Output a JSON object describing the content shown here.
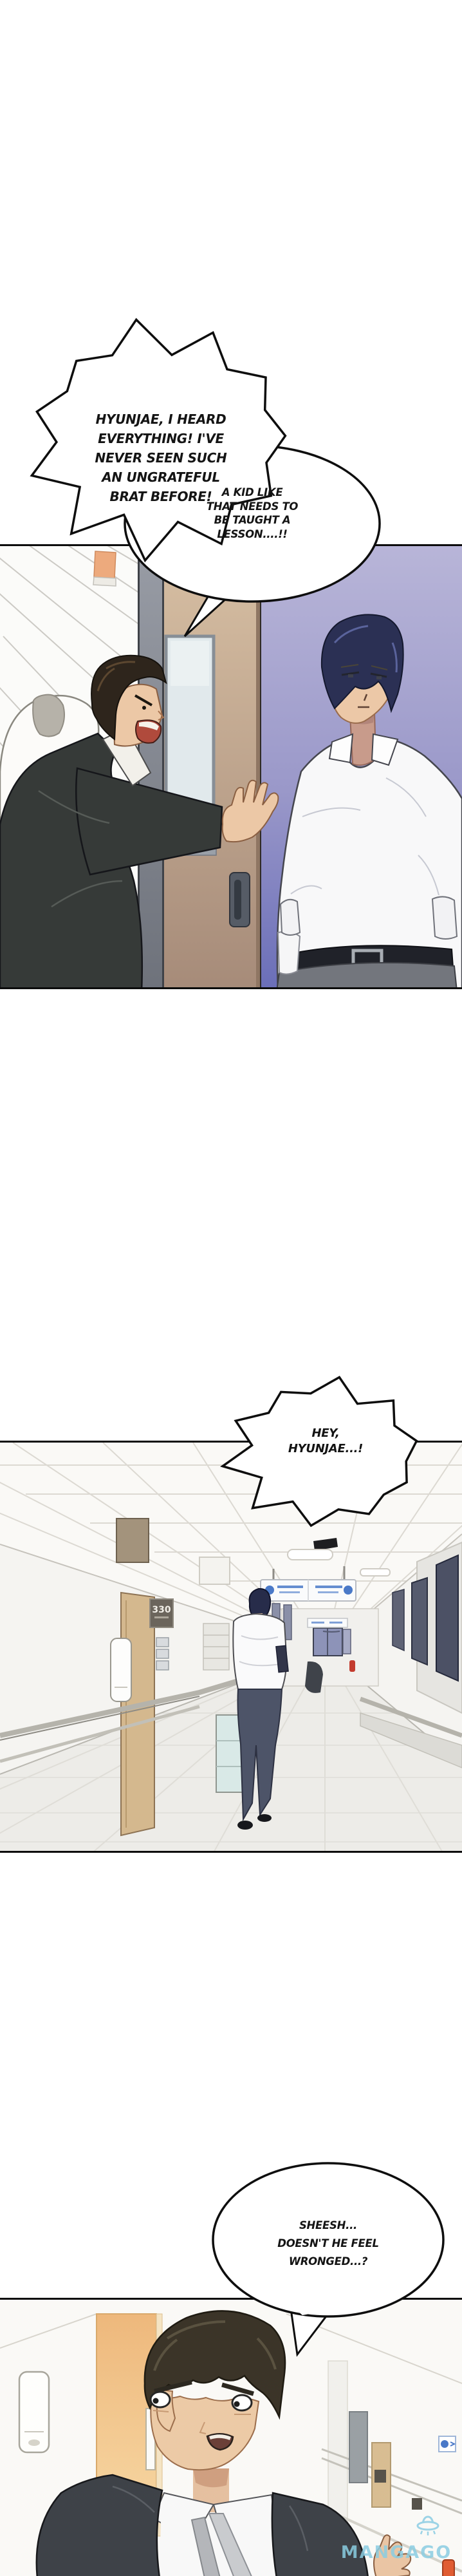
{
  "page": {
    "kind": "manhwa-comic-page"
  },
  "bubbles": {
    "b1": {
      "shape": "burst",
      "lines": [
        "HYUNJAE, I HEARD",
        "EVERYTHING! I'VE",
        "NEVER SEEN SUCH",
        "AN UNGRATEFUL",
        "BRAT BEFORE!"
      ]
    },
    "b2": {
      "shape": "rounded",
      "lines": [
        "A KID LIKE",
        "THAT NEEDS TO",
        "BE TAUGHT A",
        "LESSON....!!"
      ]
    },
    "b3": {
      "shape": "burst",
      "lines": [
        "HEY,",
        "HYUNJAE...!"
      ]
    },
    "b4": {
      "shape": "oval",
      "lines": [
        "SHEESH...",
        "DOESN'T HE FEEL",
        "WRONGED...?"
      ]
    }
  },
  "panel2": {
    "room_sign": "330"
  },
  "watermark": {
    "text": "MANGAGO",
    "icon": "ufo-icon",
    "color": "#8ccde4"
  },
  "colors": {
    "panel_border": "#0c0c0c",
    "lavender_wall_top": "#b8b5d8",
    "lavender_wall_bottom": "#6a6eb8",
    "door_beige_top": "#d7bfa3",
    "door_beige_bottom": "#a68b79",
    "suit_dark": "#363a38",
    "young_hair_navy": "#2b3054",
    "old_hair_brown": "#2e251c",
    "skin": "#ecc8a6",
    "orange_door": "#efbd80",
    "sign_blue": "#4a79c8",
    "trousers_grey": "#73767d"
  }
}
